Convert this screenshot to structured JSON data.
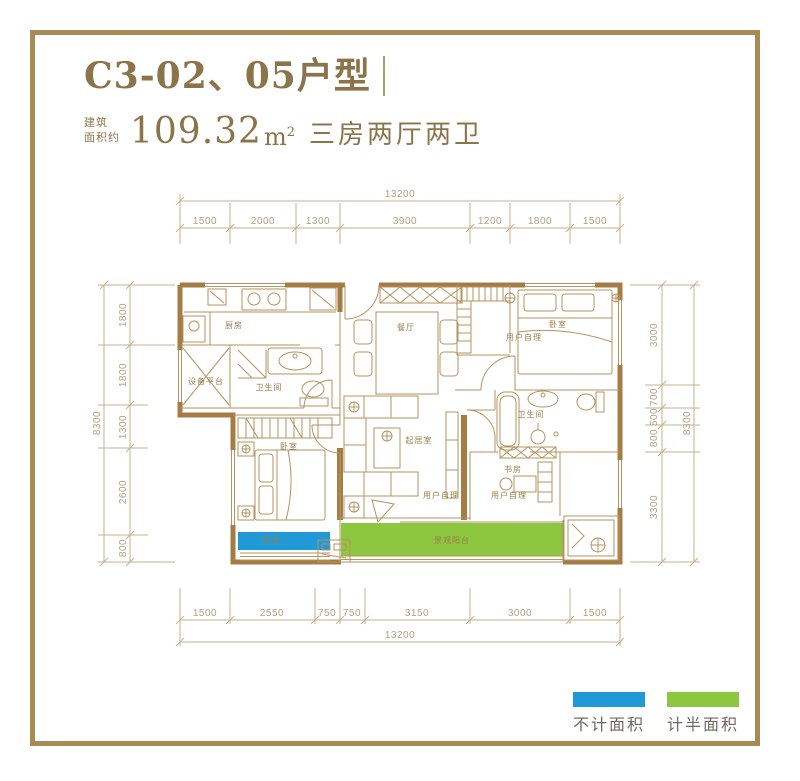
{
  "header": {
    "title": "C3-02、05户型",
    "area_prefix_line1": "建筑",
    "area_prefix_line2": "面积约",
    "area_value": "109.32",
    "area_unit": "m",
    "area_exponent": "2",
    "layout_desc": "三房两厅两卫"
  },
  "dimensions": {
    "top": {
      "total": "13200",
      "segments": [
        "1500",
        "2000",
        "1300",
        "3900",
        "1200",
        "1800",
        "1500"
      ]
    },
    "bottom": {
      "total": "13200",
      "segments": [
        "1500",
        "2550",
        "750",
        "750",
        "3150",
        "3000",
        "1500"
      ]
    },
    "left": {
      "total": "8300",
      "segments": [
        "1800",
        "1800",
        "1300",
        "2600",
        "800"
      ]
    },
    "right": {
      "total": "8300",
      "segments": [
        "3000",
        "700",
        "500",
        "800",
        "3300"
      ]
    }
  },
  "rooms": {
    "kitchen": "厨房",
    "equipment_platform": "设备平台",
    "bathroom_1": "卫生间",
    "dining": "餐厅",
    "bedroom_1": "卧室",
    "owner_note_1": "用户自理",
    "bathroom_2": "卫生间",
    "study": "书房",
    "owner_note_2": "用户自理",
    "living": "起居室",
    "owner_note_3": "用户自理",
    "bedroom_2": "卧室",
    "balcony": "景观阳台",
    "flower_bed": "花池"
  },
  "legend": {
    "items": [
      {
        "label": "不计面积",
        "color": "#1f9ad6"
      },
      {
        "label": "计半面积",
        "color": "#8dc63f"
      }
    ]
  },
  "colors": {
    "frame": "#a78b55",
    "accent_text": "#8c744a",
    "wall": "#a57c44",
    "thin_line": "#b6925f",
    "dimension_line": "#c6b28c",
    "dimension_text": "#afa081",
    "no_area_fill": "#1f9ad6",
    "half_area_fill": "#8dc63f"
  }
}
